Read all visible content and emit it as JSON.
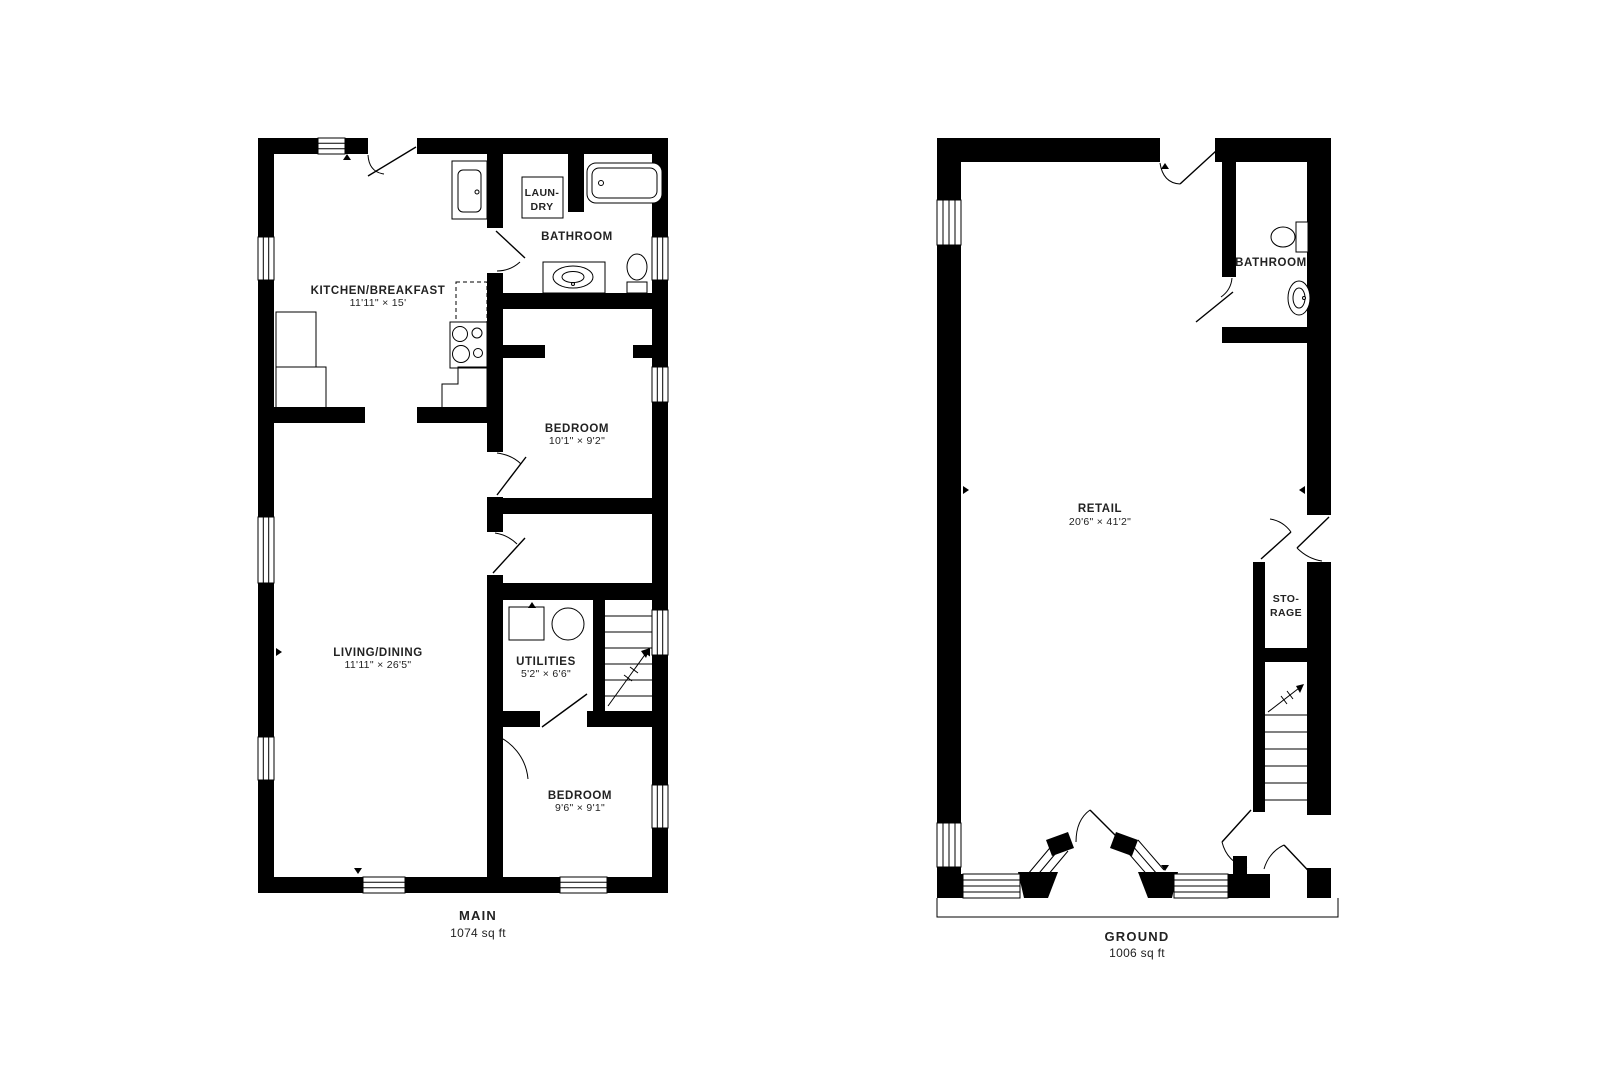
{
  "plans": {
    "main": {
      "title": "MAIN",
      "area": "1074 sq ft",
      "rooms": {
        "kitchen": {
          "label": "KITCHEN/BREAKFAST",
          "dims": "11'11\" × 15'"
        },
        "laundry": {
          "line1": "LAUN-",
          "line2": "DRY"
        },
        "bathroom": {
          "label": "BATHROOM"
        },
        "bedroom1": {
          "label": "BEDROOM",
          "dims": "10'1\" × 9'2\""
        },
        "living": {
          "label": "LIVING/DINING",
          "dims": "11'11\" × 26'5\""
        },
        "utilities": {
          "label": "UTILITIES",
          "dims": "5'2\" × 6'6\""
        },
        "bedroom2": {
          "label": "BEDROOM",
          "dims": "9'6\" × 9'1\""
        }
      }
    },
    "ground": {
      "title": "GROUND",
      "area": "1006 sq ft",
      "rooms": {
        "retail": {
          "label": "RETAIL",
          "dims": "20'6\" × 41'2\""
        },
        "bathroom": {
          "label": "BATHROOM"
        },
        "storage": {
          "line1": "STO-",
          "line2": "RAGE"
        }
      }
    }
  },
  "colors": {
    "wall": "#000000",
    "background": "#ffffff",
    "text": "#222222"
  }
}
